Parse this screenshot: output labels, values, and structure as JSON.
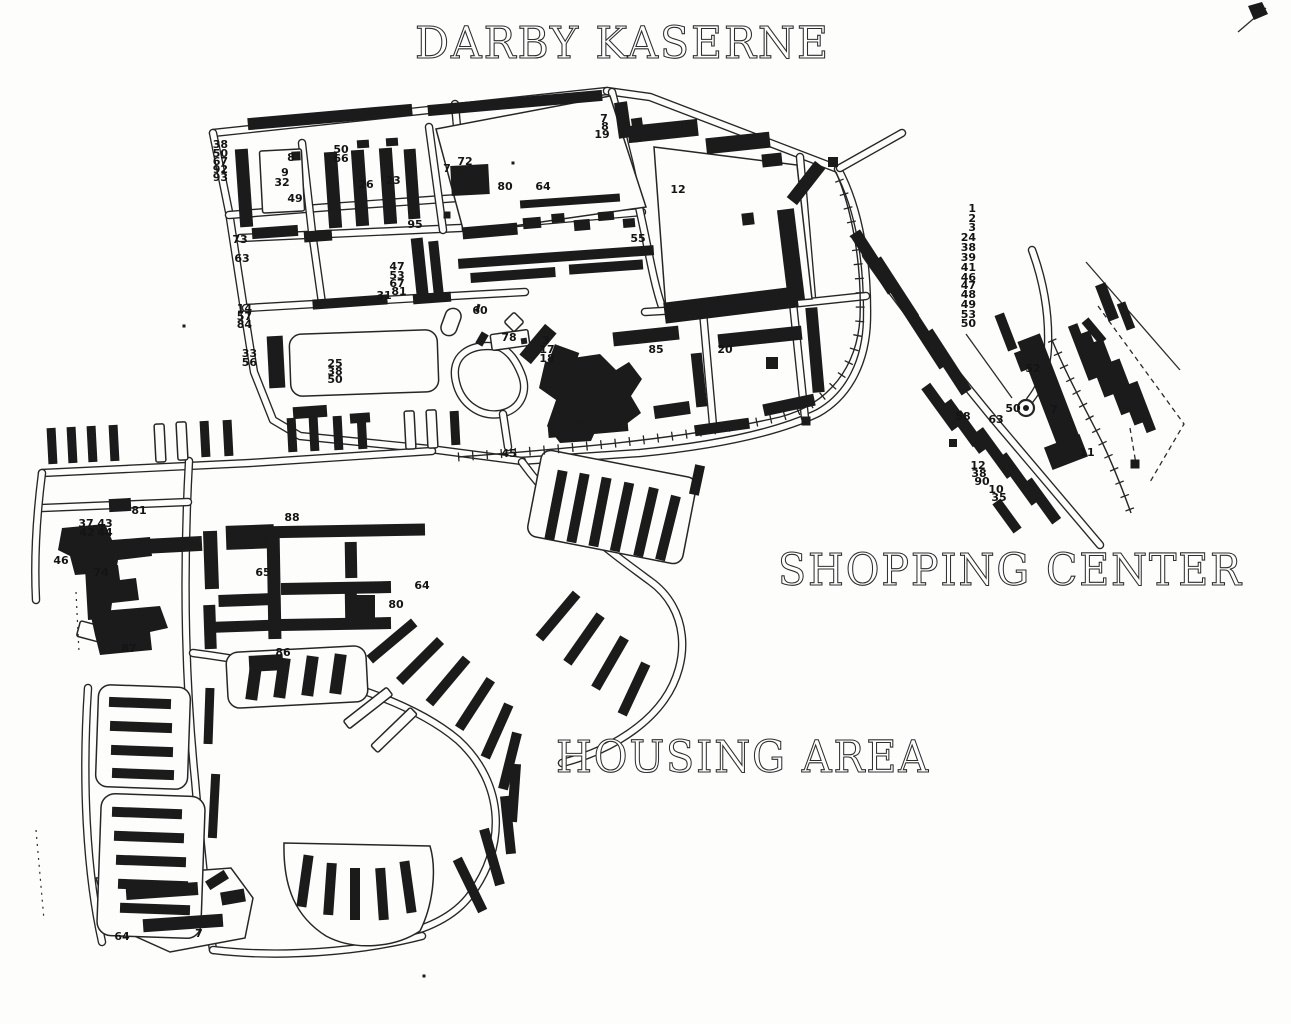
{
  "map": {
    "title": "DARBY KASERNE",
    "region_labels": [
      {
        "text": "SHOPPING CENTER"
      },
      {
        "text": "HOUSING AREA"
      }
    ],
    "colors": {
      "ink": "#1b1b1b",
      "paper": "#fdfdfb"
    },
    "symbols": [
      {
        "name": "circled-dot-marker",
        "label": "50"
      }
    ],
    "building_numbers": [
      {
        "t": "38",
        "x": 228,
        "y": 148,
        "a": "e"
      },
      {
        "t": "50",
        "x": 228,
        "y": 157,
        "a": "e"
      },
      {
        "t": "67",
        "x": 228,
        "y": 165,
        "a": "e"
      },
      {
        "t": "92",
        "x": 228,
        "y": 173,
        "a": "e"
      },
      {
        "t": "93",
        "x": 228,
        "y": 181,
        "a": "e"
      },
      {
        "t": "8",
        "x": 291,
        "y": 161
      },
      {
        "t": "9",
        "x": 285,
        "y": 176
      },
      {
        "t": "32",
        "x": 282,
        "y": 186
      },
      {
        "t": "49",
        "x": 295,
        "y": 202
      },
      {
        "t": "50",
        "x": 341,
        "y": 153
      },
      {
        "t": "66",
        "x": 341,
        "y": 162
      },
      {
        "t": "26",
        "x": 366,
        "y": 188
      },
      {
        "t": "23",
        "x": 393,
        "y": 184
      },
      {
        "t": "95",
        "x": 415,
        "y": 228
      },
      {
        "t": "73",
        "x": 240,
        "y": 243
      },
      {
        "t": "63",
        "x": 242,
        "y": 262
      },
      {
        "t": "47",
        "x": 397,
        "y": 270
      },
      {
        "t": "53",
        "x": 397,
        "y": 279
      },
      {
        "t": "67",
        "x": 397,
        "y": 287
      },
      {
        "t": "81",
        "x": 399,
        "y": 295
      },
      {
        "t": "31",
        "x": 384,
        "y": 299
      },
      {
        "t": "14",
        "x": 252,
        "y": 312,
        "a": "e"
      },
      {
        "t": "57",
        "x": 252,
        "y": 320,
        "a": "e"
      },
      {
        "t": "84",
        "x": 252,
        "y": 328,
        "a": "e"
      },
      {
        "t": "33",
        "x": 257,
        "y": 357,
        "a": "e"
      },
      {
        "t": "56",
        "x": 257,
        "y": 366,
        "a": "e"
      },
      {
        "t": "25",
        "x": 335,
        "y": 367
      },
      {
        "t": "38",
        "x": 335,
        "y": 375
      },
      {
        "t": "50",
        "x": 335,
        "y": 383
      },
      {
        "t": "7",
        "x": 447,
        "y": 172
      },
      {
        "t": "72",
        "x": 465,
        "y": 165
      },
      {
        "t": "80",
        "x": 505,
        "y": 190
      },
      {
        "t": "64",
        "x": 543,
        "y": 190
      },
      {
        "t": "7",
        "x": 604,
        "y": 122
      },
      {
        "t": "8",
        "x": 605,
        "y": 130
      },
      {
        "t": "19",
        "x": 602,
        "y": 138
      },
      {
        "t": "12",
        "x": 678,
        "y": 193
      },
      {
        "t": "55",
        "x": 638,
        "y": 242
      },
      {
        "t": "60",
        "x": 480,
        "y": 314
      },
      {
        "t": "78",
        "x": 509,
        "y": 341
      },
      {
        "t": "3",
        "x": 546,
        "y": 344
      },
      {
        "t": "17",
        "x": 547,
        "y": 353
      },
      {
        "t": "18",
        "x": 547,
        "y": 362
      },
      {
        "t": "85",
        "x": 656,
        "y": 353
      },
      {
        "t": "20",
        "x": 725,
        "y": 353
      },
      {
        "t": "45",
        "x": 509,
        "y": 457
      },
      {
        "t": "1",
        "x": 976,
        "y": 212,
        "a": "e"
      },
      {
        "t": "2",
        "x": 976,
        "y": 222,
        "a": "e"
      },
      {
        "t": "3",
        "x": 976,
        "y": 231,
        "a": "e"
      },
      {
        "t": "24",
        "x": 976,
        "y": 241,
        "a": "e"
      },
      {
        "t": "38",
        "x": 976,
        "y": 251,
        "a": "e"
      },
      {
        "t": "39",
        "x": 976,
        "y": 261,
        "a": "e"
      },
      {
        "t": "41",
        "x": 976,
        "y": 271,
        "a": "e"
      },
      {
        "t": "46",
        "x": 976,
        "y": 281,
        "a": "e"
      },
      {
        "t": "47",
        "x": 976,
        "y": 289,
        "a": "e"
      },
      {
        "t": "48",
        "x": 976,
        "y": 298,
        "a": "e"
      },
      {
        "t": "49",
        "x": 976,
        "y": 308,
        "a": "e"
      },
      {
        "t": "53",
        "x": 976,
        "y": 318,
        "a": "e"
      },
      {
        "t": "50",
        "x": 976,
        "y": 327,
        "a": "e"
      },
      {
        "t": "52",
        "x": 1033,
        "y": 372
      },
      {
        "t": "50",
        "x": 1013,
        "y": 412
      },
      {
        "t": "7",
        "x": 1054,
        "y": 413
      },
      {
        "t": "11",
        "x": 1087,
        "y": 456
      },
      {
        "t": "58",
        "x": 963,
        "y": 420
      },
      {
        "t": "63",
        "x": 996,
        "y": 423
      },
      {
        "t": "12",
        "x": 978,
        "y": 469
      },
      {
        "t": "38",
        "x": 979,
        "y": 477
      },
      {
        "t": "90",
        "x": 982,
        "y": 485
      },
      {
        "t": "10",
        "x": 996,
        "y": 493
      },
      {
        "t": "35",
        "x": 999,
        "y": 501
      },
      {
        "t": "81",
        "x": 139,
        "y": 514
      },
      {
        "t": "37",
        "x": 86,
        "y": 527
      },
      {
        "t": "43",
        "x": 105,
        "y": 527
      },
      {
        "t": "42",
        "x": 87,
        "y": 536
      },
      {
        "t": "44",
        "x": 105,
        "y": 536
      },
      {
        "t": "46",
        "x": 61,
        "y": 564
      },
      {
        "t": "74",
        "x": 101,
        "y": 576
      },
      {
        "t": "87",
        "x": 129,
        "y": 652
      },
      {
        "t": "88",
        "x": 292,
        "y": 521
      },
      {
        "t": "65",
        "x": 263,
        "y": 576
      },
      {
        "t": "64",
        "x": 422,
        "y": 589
      },
      {
        "t": "80",
        "x": 396,
        "y": 608
      },
      {
        "t": "86",
        "x": 283,
        "y": 656
      },
      {
        "t": "64",
        "x": 122,
        "y": 940
      },
      {
        "t": "7",
        "x": 199,
        "y": 937
      }
    ]
  }
}
